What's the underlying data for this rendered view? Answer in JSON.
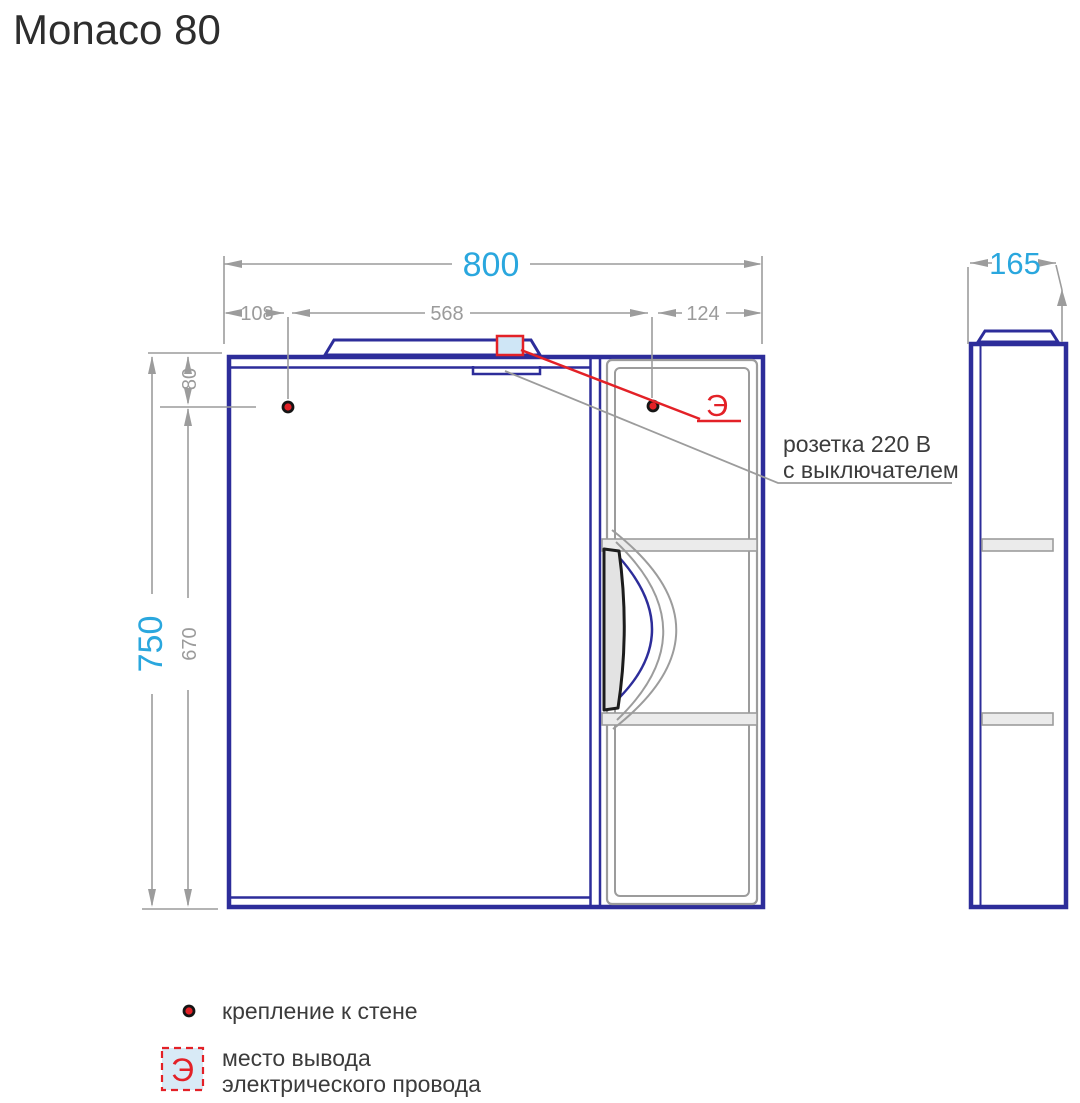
{
  "title": "Monaco 80",
  "front_view": {
    "dims": {
      "width_total": "800",
      "mount_left_offset": "108",
      "mount_spacing": "568",
      "mount_right_offset": "124",
      "mount_top_offset": "80",
      "height_total": "750",
      "mount_to_bottom": "670"
    }
  },
  "side_view": {
    "dims": {
      "depth_total": "165"
    }
  },
  "annotations": {
    "electric_symbol": "Э",
    "socket_label_line1": "розетка 220 В",
    "socket_label_line2": "с выключателем"
  },
  "legend": {
    "mount_label": "крепление к стене",
    "electric_symbol": "Э",
    "electric_label_line1": "место вывода",
    "electric_label_line2": "электрического провода"
  },
  "colors": {
    "cabinet_blue": "#2d2d9a",
    "dimension_gray": "#9c9c9c",
    "accent_cyan": "#2aa7de",
    "accent_red": "#e32127",
    "text_dark": "#3c3c3c"
  }
}
